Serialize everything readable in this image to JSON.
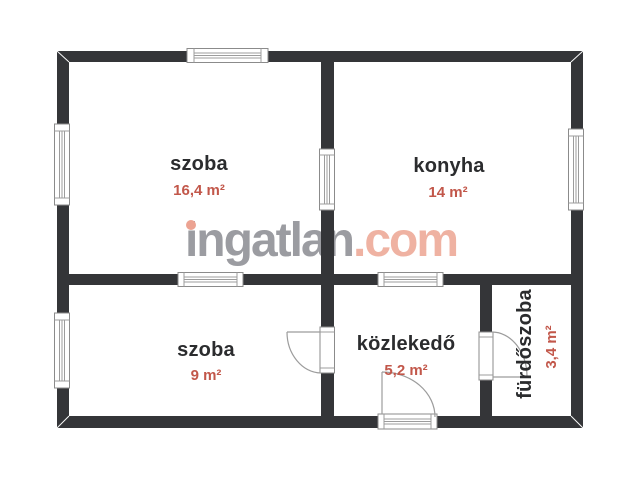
{
  "watermark": {
    "text": "ingatlan.com",
    "gray_part": "ingatlan",
    "red_part": ".com"
  },
  "rooms": [
    {
      "name": "szoba",
      "area": "16,4 m²"
    },
    {
      "name": "konyha",
      "area": "14 m²"
    },
    {
      "name": "szoba",
      "area": "9 m²"
    },
    {
      "name": "közlekedő",
      "area": "5,2 m²"
    },
    {
      "name": "fürdőszoba",
      "area": "3,4 m²"
    }
  ],
  "colors": {
    "background": "#ffffff",
    "wall": "#343538",
    "room_name": "#2b2c2e",
    "room_area": "#c2574a",
    "watermark_gray": "#9b9ca1",
    "watermark_accent": "#efb2a2",
    "window_frame": "#8b8b8b",
    "door_swing": "#9c9c9c"
  }
}
